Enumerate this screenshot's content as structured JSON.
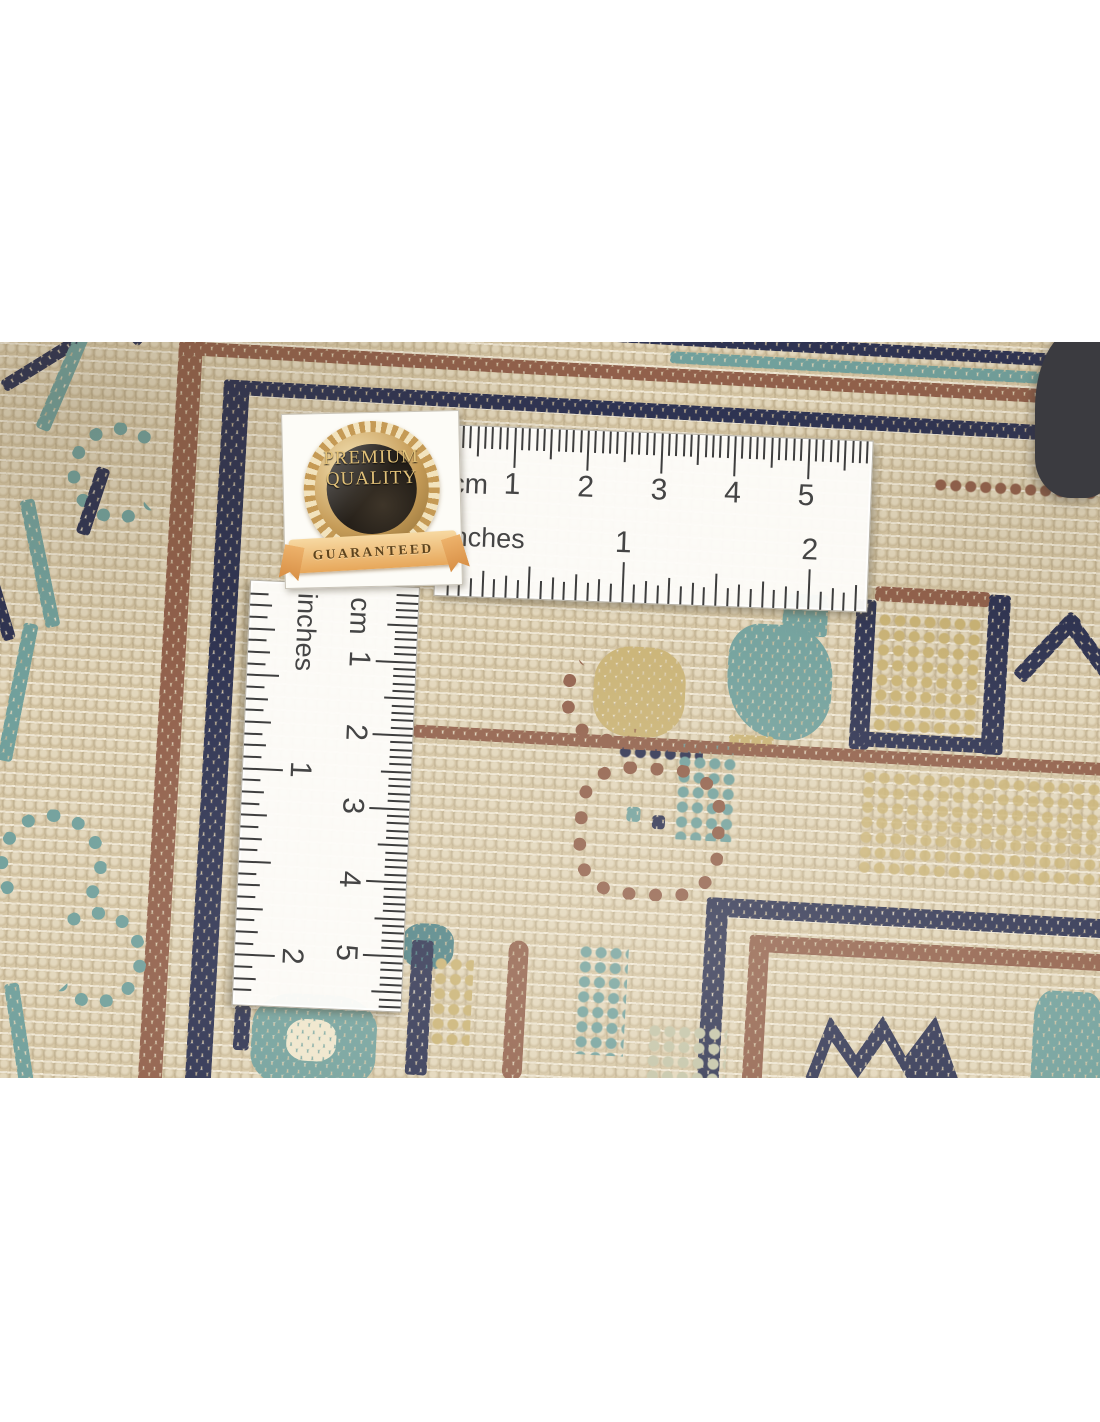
{
  "badge": {
    "line1": "PREMIUM",
    "line2": "QUALITY",
    "ribbon": "GUARANTEED"
  },
  "horizontal_ruler": {
    "cm_label": "cm",
    "inch_label": "inches",
    "cm_numbers": [
      "1",
      "2",
      "3",
      "4",
      "5"
    ],
    "inch_numbers": [
      "1",
      "2"
    ]
  },
  "vertical_ruler": {
    "cm_label": "cm",
    "inch_label": "inches",
    "cm_numbers": [
      "1",
      "2",
      "3",
      "4",
      "5"
    ],
    "inch_numbers": [
      "1",
      "2"
    ]
  },
  "palette": {
    "carpet_base": "#d6c6a4",
    "weft_white": "#f3ecd8",
    "navy": "#2e3352",
    "rust_brown": "#91604b",
    "teal": "#71a09c",
    "gold_khaki": "#c9b274",
    "ruler_white": "#fdfcf9",
    "ruler_text": "#454545",
    "badge_gold": "#e2c178",
    "badge_dark_core": "#191511",
    "ribbon_gold": "#e7a75a",
    "dark_object": "#3b3b40",
    "page_background": "#ffffff"
  }
}
